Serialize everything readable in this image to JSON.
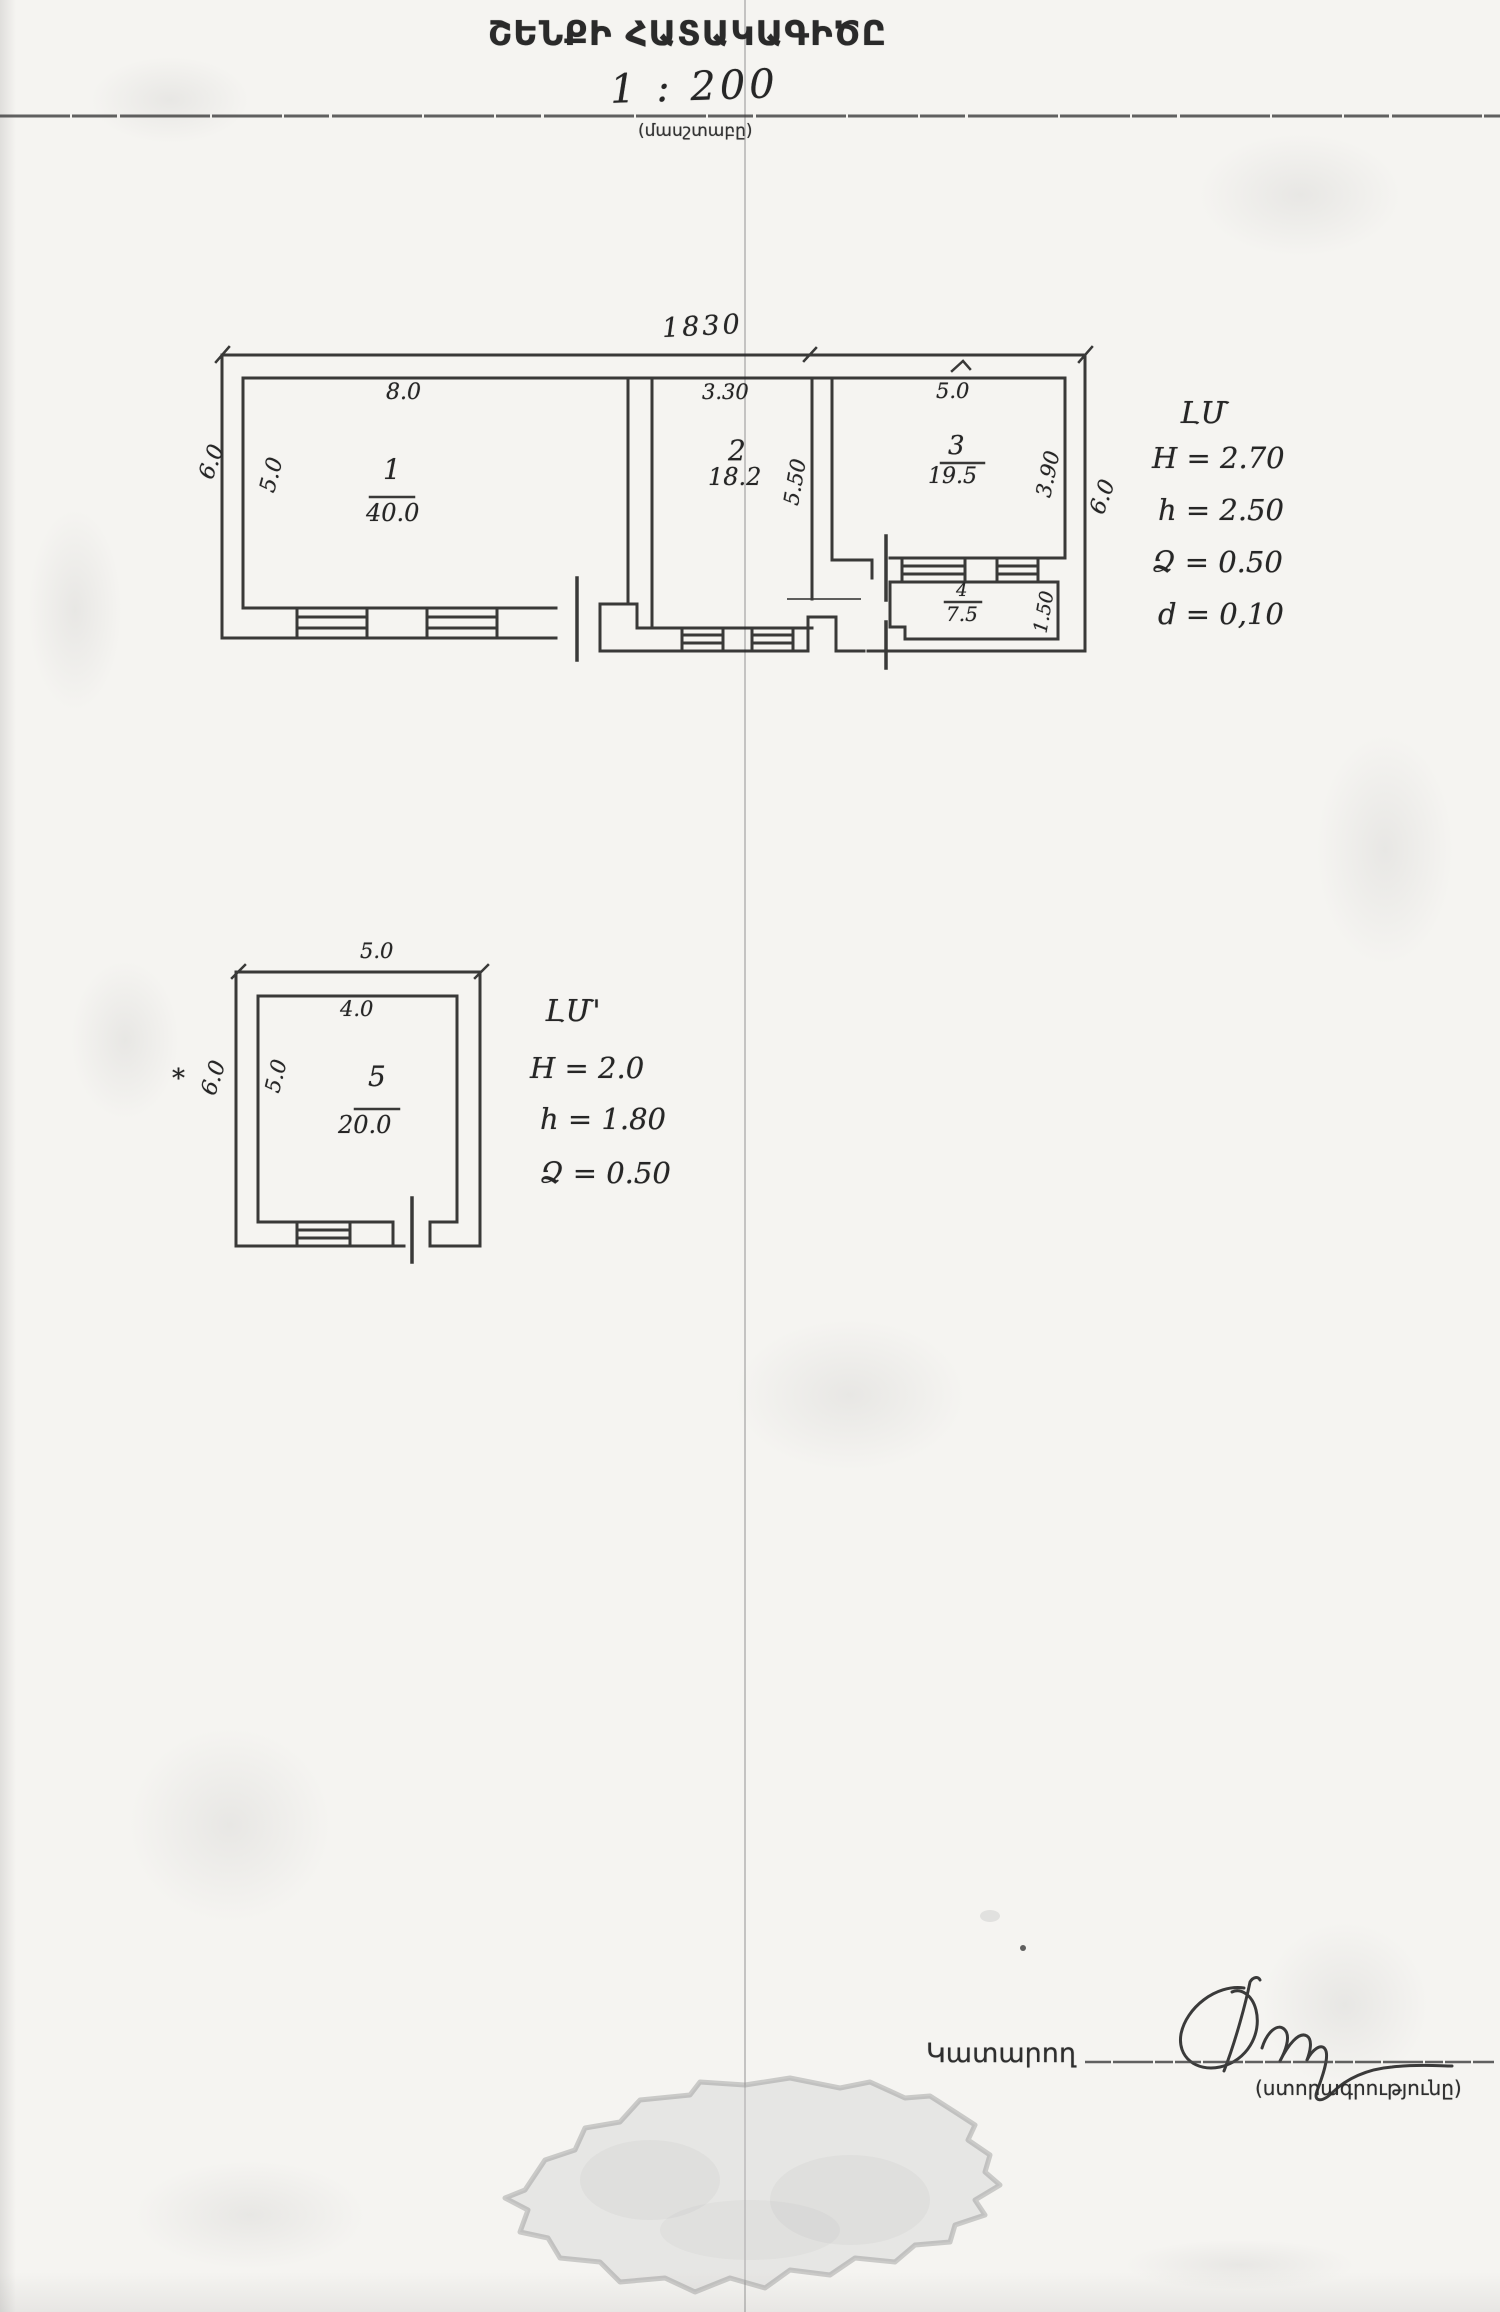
{
  "page": {
    "title": "ՇԵՆՔԻ ՀԱՏԱԿԱԳԻԾԸ",
    "scale_ratio": "1 : 200",
    "scale_caption": "(մասշտաբը)"
  },
  "main_plan": {
    "overall_width_label": "1830",
    "dims": {
      "outer_left": "6.0",
      "room1_width": "8.0",
      "room1_height": "5.0",
      "room2_width": "3.30",
      "room2_height": "5.50",
      "room3_width": "5.0",
      "room3_height": "3.90",
      "room4_height": "1.50",
      "outer_right": "6.0"
    },
    "rooms": [
      {
        "number": "1",
        "area": "40.0"
      },
      {
        "number": "2",
        "area": "18.2"
      },
      {
        "number": "3",
        "area": "19.5"
      },
      {
        "number": "4",
        "area": "7.5"
      }
    ],
    "notes": {
      "header": "ԼՄ",
      "lines": [
        "H = 2.70",
        "h = 2.50",
        "Ձ = 0.50",
        "d = 0,10"
      ]
    }
  },
  "second_plan": {
    "dims": {
      "outer_width": "5.0",
      "inner_width": "4.0",
      "outer_left": "6.0",
      "inner_left": "5.0"
    },
    "room": {
      "number": "5",
      "area": "20.0"
    },
    "notes": {
      "header": "ԼՄ'",
      "lines": [
        "H = 2.0",
        "h = 1.80",
        "Ձ = 0.50"
      ]
    },
    "asterisk_mark": "*"
  },
  "footer": {
    "executor_label": "Կատարող",
    "signature_caption": "(ստորագրությունը)"
  },
  "colors": {
    "ink": "#2b2b2b",
    "paper": "#f5f4f1",
    "stamp": "#c9c9c9"
  }
}
